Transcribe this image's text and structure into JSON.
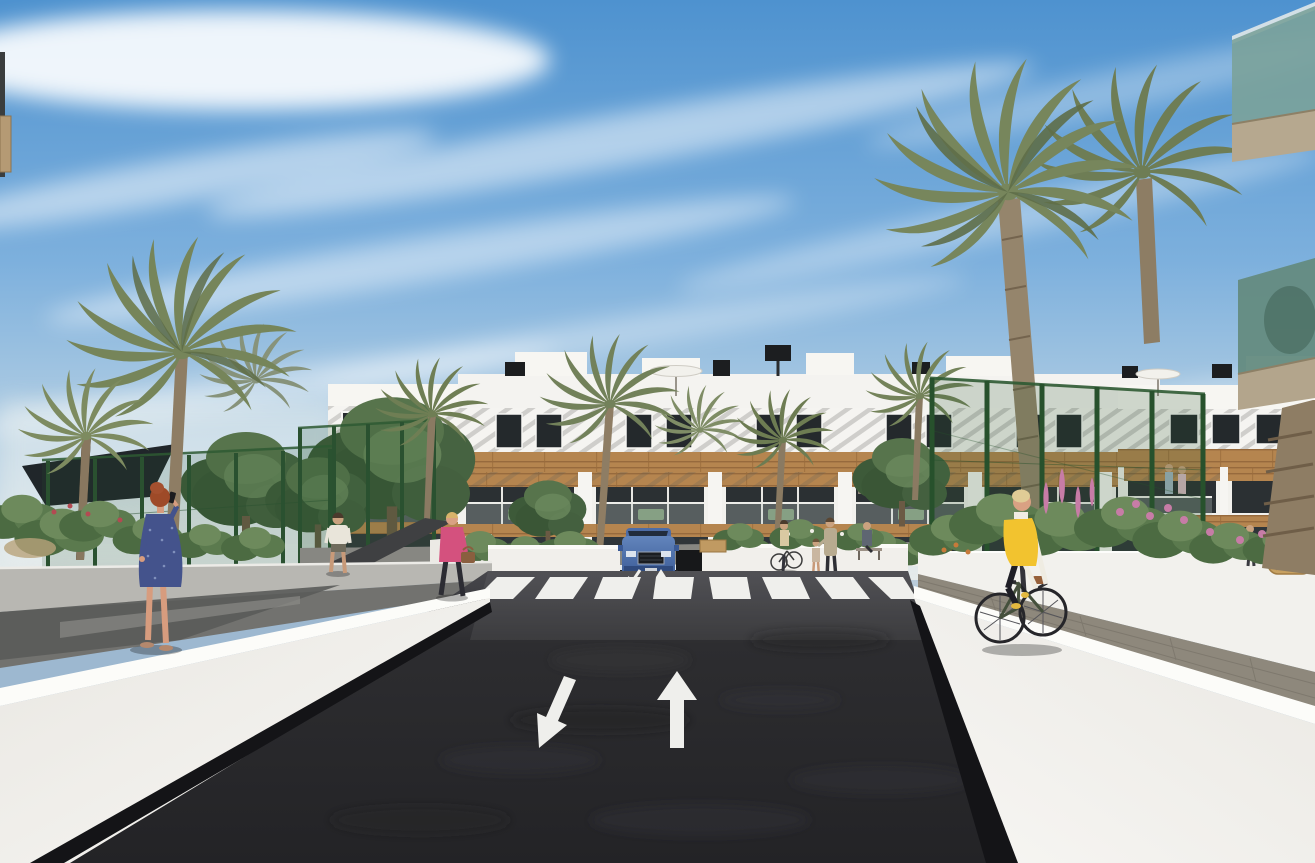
{
  "scene": {
    "caption": "Architectural 3D rendering of a modern white three-storey apartment complex with wood cladding, palm trees, a dark asphalt access road with crosswalk and lane arrows, pedestrians and a cyclist on a sunny day",
    "time_of_day": "day",
    "weather": "sunny with wispy cirrus clouds"
  },
  "palette": {
    "sky_top": "#4e92cf",
    "sky_mid": "#7db0dd",
    "sky_horizon": "#e3e9e9",
    "cloud_white": "#ffffff",
    "facade_white": "#f4f3f0",
    "facade_shadow": "#d8d5cf",
    "wood_cladding": "#b5854f",
    "wood_dark": "#8d6136",
    "window_glass": "#24292c",
    "pergola_slat": "#5b5b57",
    "fence_green": "#2e5a33",
    "foliage_dark": "#3d5a39",
    "foliage_mid": "#57744c",
    "palm_frond": "#77865c",
    "palm_trunk": "#8e7d64",
    "flower_pink": "#c77ca6",
    "flower_orange": "#c77a3a",
    "balcony_glass_teal": "#7ba29a",
    "wall_white": "#fcfcf9",
    "walkway_gray": "#72726f",
    "paver_gray": "#8e887c",
    "asphalt_dark": "#28282b",
    "asphalt_light": "#3a3a3f",
    "marking_white": "#efefec",
    "suv_blue": "#3f5f9f",
    "vest_yellow": "#f2c32f",
    "dress_blue": "#44538c",
    "jacket_pink": "#d4517e",
    "skin": "#d79c7e",
    "base_shadow": "#141417"
  },
  "road": {
    "surface": "dark asphalt",
    "crosswalk_stripe_count": 8,
    "lane_arrows": [
      {
        "name": "lane-arrow-toward-viewer",
        "direction": "down-left"
      },
      {
        "name": "lane-arrow-away",
        "direction": "up"
      }
    ],
    "mini_arrow_count": 2
  },
  "buildings": {
    "storeys": 3,
    "facade": "white with horizontal wood cladding bands",
    "roof": "flat parapet with pergolas, umbrellas and black vents",
    "balconies": "glass balustrades with wood pergolas and green patio furniture",
    "foreground_feature": "green-tinted glass balcony corners at top right"
  },
  "vehicles": [
    {
      "type": "suv",
      "color": "#3f5f9f",
      "position": "emerging from garage ramp behind crosswalk"
    }
  ],
  "people": [
    {
      "id": "woman-on-phone",
      "hair": "auburn",
      "outfit_color": "#44538c",
      "activity": "standing on left walkway talking on phone"
    },
    {
      "id": "woman-walking-with-bag",
      "outfit_color": "#d4517e",
      "bag_color": "#8a5f3f",
      "activity": "walking left on path"
    },
    {
      "id": "man-walking",
      "outfit_color": "#e9e5da",
      "activity": "walking away on left path"
    },
    {
      "id": "cyclist",
      "vest_color": "#f2c32f",
      "activity": "riding bicycle on right walkway"
    },
    {
      "id": "woman-with-bicycle",
      "activity": "standing near building entrance"
    },
    {
      "id": "mother-with-child",
      "activity": "standing near building entrance"
    },
    {
      "id": "person-on-bench",
      "activity": "sitting on bench"
    },
    {
      "id": "couple-on-balcony",
      "activity": "standing on first-floor balcony"
    },
    {
      "id": "person-near-terrace",
      "activity": "standing near right terrace"
    }
  ],
  "vegetation": {
    "palm_trees": 9,
    "deciduous_trees": 5,
    "shrubs": "green bushes with pink and orange flowers",
    "fences": 3
  }
}
